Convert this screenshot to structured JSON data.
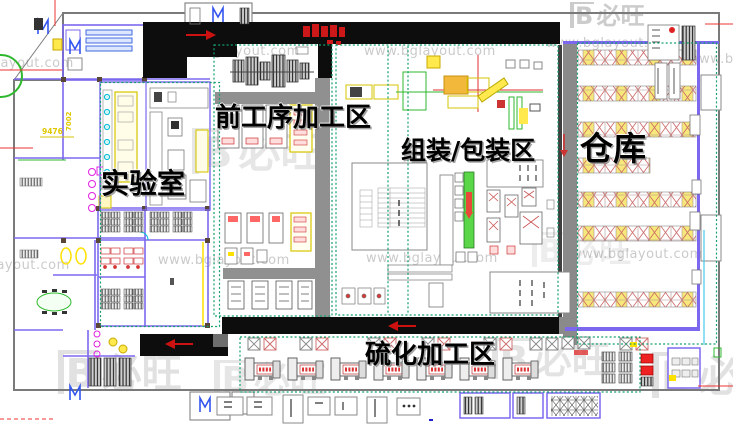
{
  "page": {
    "description": "CAD factory floor-plan layout screenshot with zone labels"
  },
  "zones": {
    "pre_process": {
      "label": "前工序加工区"
    },
    "laboratory": {
      "label": "实验室"
    },
    "assembly_packaging": {
      "label": "组装/包装区"
    },
    "warehouse": {
      "label": "仓库"
    },
    "vulcanization": {
      "label": "硫化加工区"
    }
  },
  "dimensions": {
    "width_label": "9476",
    "height_label": "7002"
  },
  "watermark": {
    "url": "www.bglayout.com",
    "logo_mark": "B",
    "logo_text": "必旺"
  },
  "colors": {
    "zone_boundary": "#13a06b",
    "corridor_black": "#0d0d0d",
    "wall_purple": "#7b68ee",
    "rack_red": "#cc5555",
    "rack_yellow": "#f6e87a",
    "conveyor_green": "#5ad648",
    "arrow_red": "#cc1818",
    "highlight_yellow": "#ffe100",
    "magenta": "#e020e0",
    "cyan": "#00bcd4"
  }
}
